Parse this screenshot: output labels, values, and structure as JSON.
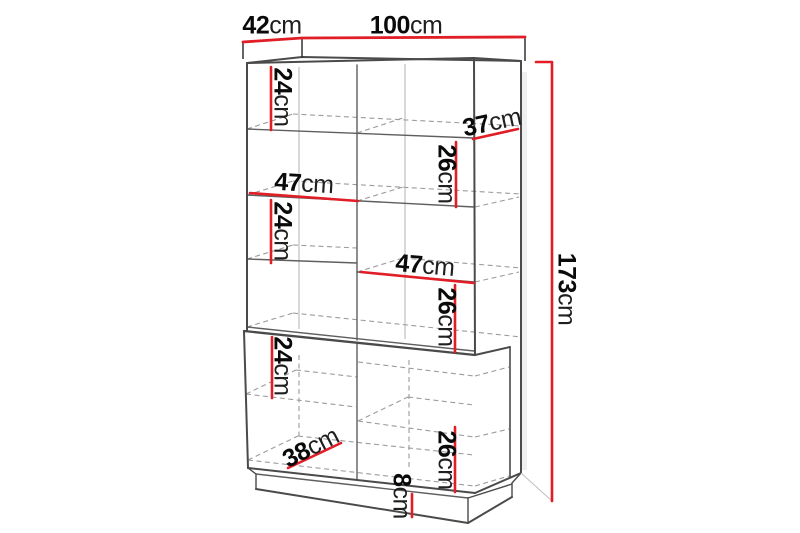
{
  "figure": {
    "type": "furniture-dimension-diagram",
    "subject": "display cabinet with lower doors and plinth",
    "unit": "cm",
    "colors": {
      "dimension_line": "#e11d26",
      "outline": "#4a4a4a",
      "hidden_line": "#9b9b9b",
      "text": "#0a0a0a",
      "background": "#ffffff"
    },
    "dimensions": {
      "top_depth": {
        "value": "42",
        "unit": "cm"
      },
      "top_width": {
        "value": "100",
        "unit": "cm"
      },
      "total_height": {
        "value": "173",
        "unit": "cm"
      },
      "upper_left_cell1_height": {
        "value": "24",
        "unit": "cm"
      },
      "shelf_depth": {
        "value": "37",
        "unit": "cm"
      },
      "upper_right_cell_height": {
        "value": "26",
        "unit": "cm"
      },
      "left_column_width": {
        "value": "47",
        "unit": "cm"
      },
      "upper_left_cell3_height": {
        "value": "24",
        "unit": "cm"
      },
      "right_column_width": {
        "value": "47",
        "unit": "cm"
      },
      "upper_right_cell2_height": {
        "value": "26",
        "unit": "cm"
      },
      "lower_left_cell_height": {
        "value": "24",
        "unit": "cm"
      },
      "lower_interior_depth": {
        "value": "38",
        "unit": "cm"
      },
      "lower_right_cell_height": {
        "value": "26",
        "unit": "cm"
      },
      "plinth_height": {
        "value": "8",
        "unit": "cm"
      }
    }
  }
}
